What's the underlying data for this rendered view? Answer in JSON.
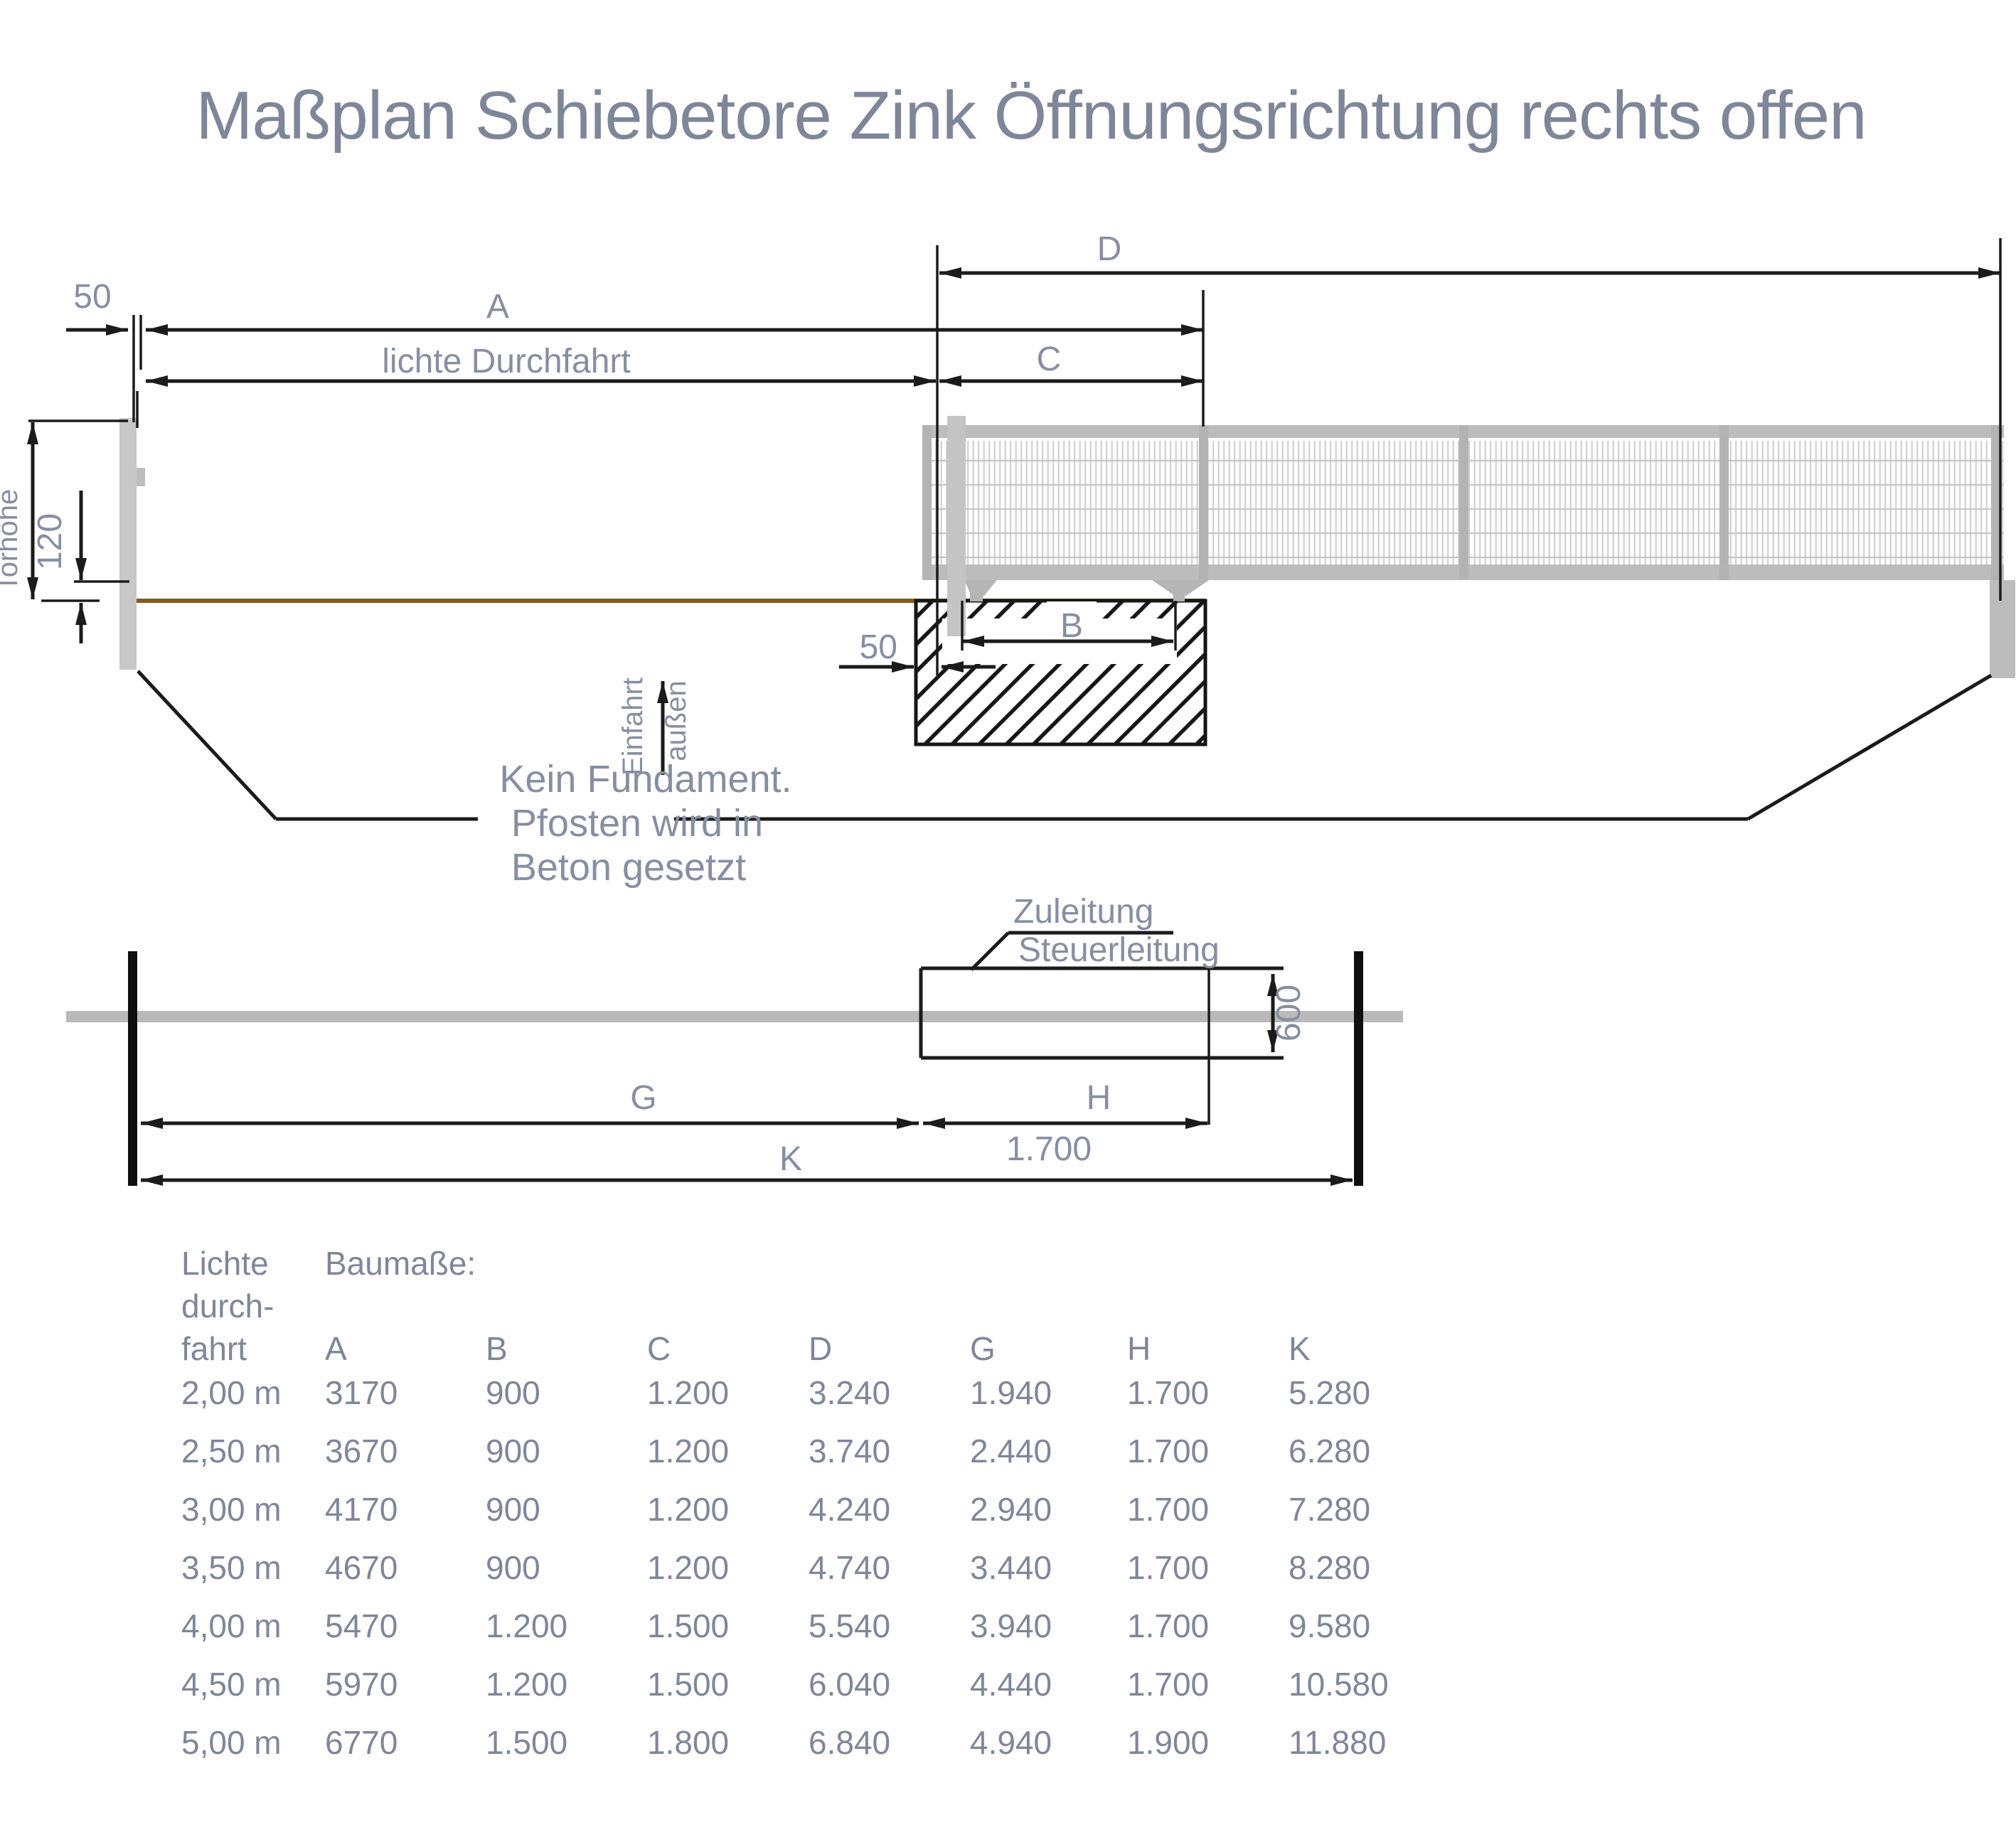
{
  "title": "Maßplan Schiebetore Zink Öffnungsrichtung rechts offen",
  "colors": {
    "label_gray": "#868fa1",
    "title_gray": "#7e8799",
    "line_black": "#1b1b1b",
    "gate_gray": "#c0c0c0",
    "ground_brown": "#8a591d",
    "plan_bar_gray": "#b9b9b9"
  },
  "top_view": {
    "dim_50_post": "50",
    "dim_a": "A",
    "dim_lichte": "lichte Durchfahrt",
    "dim_d": "D",
    "dim_c": "C",
    "dim_b": "B",
    "dim_torhoehe": "Torhöhe",
    "dim_120": "120",
    "dim_50_foundation": "50",
    "arrow_label_left": "Einfahrt",
    "arrow_label_right": "außen",
    "note_line1": "Kein Fundament.",
    "note_line2": "Pfosten wird in",
    "note_line3": "Beton gesetzt"
  },
  "plan_view": {
    "label_zuleitung": "Zuleitung",
    "label_steuerleitung": "Steuerleitung",
    "dim_600": "600",
    "dim_g": "G",
    "dim_h": "H",
    "dim_1700": "1.700",
    "dim_k": "K"
  },
  "table": {
    "header": {
      "col1_line1": "Lichte",
      "col1_line2": "durch-",
      "col1_line3": "fahrt",
      "baumasse": "Baumaße:",
      "columns": [
        "A",
        "B",
        "C",
        "D",
        "G",
        "H",
        "K"
      ]
    },
    "rows": [
      {
        "lichte": "2,00 m",
        "values": [
          "3170",
          "900",
          "1.200",
          "3.240",
          "1.940",
          "1.700",
          "5.280"
        ]
      },
      {
        "lichte": "2,50 m",
        "values": [
          "3670",
          "900",
          "1.200",
          "3.740",
          "2.440",
          "1.700",
          "6.280"
        ]
      },
      {
        "lichte": "3,00 m",
        "values": [
          "4170",
          "900",
          "1.200",
          "4.240",
          "2.940",
          "1.700",
          "7.280"
        ]
      },
      {
        "lichte": "3,50 m",
        "values": [
          "4670",
          "900",
          "1.200",
          "4.740",
          "3.440",
          "1.700",
          "8.280"
        ]
      },
      {
        "lichte": "4,00 m",
        "values": [
          "5470",
          "1.200",
          "1.500",
          "5.540",
          "3.940",
          "1.700",
          "9.580"
        ]
      },
      {
        "lichte": "4,50 m",
        "values": [
          "5970",
          "1.200",
          "1.500",
          "6.040",
          "4.440",
          "1.700",
          "10.580"
        ]
      },
      {
        "lichte": "5,00 m",
        "values": [
          "6770",
          "1.500",
          "1.800",
          "6.840",
          "4.940",
          "1.900",
          "11.880"
        ]
      }
    ]
  }
}
